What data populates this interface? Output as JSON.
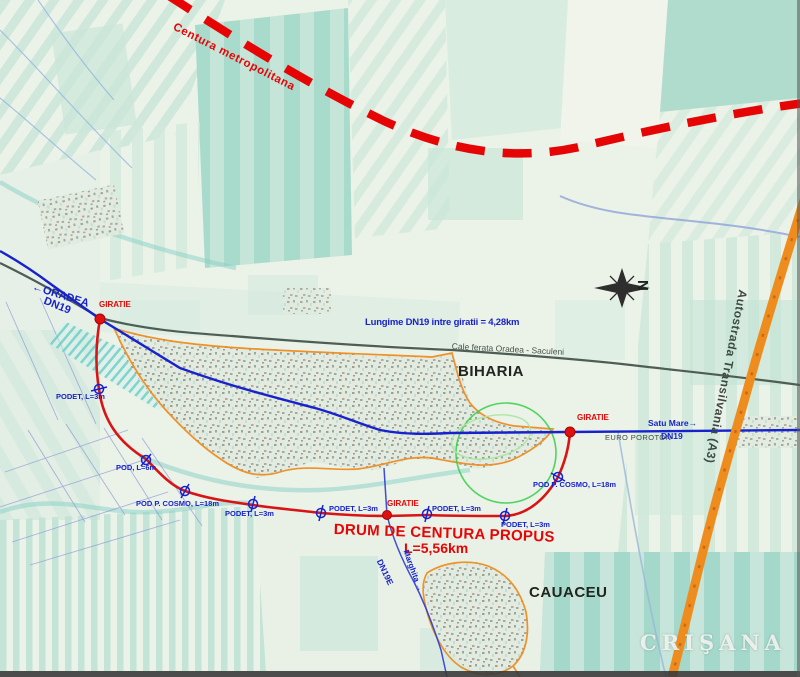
{
  "map": {
    "region_labels": {
      "biharia": "BIHARIA",
      "cauaceu": "CAUACEU"
    },
    "roads": {
      "centura_metropolitana": "Centura metropolitana",
      "dn19_left": "DN19",
      "dn19_right": "DN19",
      "dn19e": "DN19E",
      "autostrada_a3": "Autostrada Transilvania (A3)",
      "cale_ferata": "Cale ferata Oradea - Saculeni",
      "drum_title": "DRUM DE CENTURA PROPUS",
      "drum_length": "L=5,56km",
      "lungime_note": "Lungime DN19 intre giratii = 4,28km"
    },
    "destinations": {
      "oradea": "ORADEA",
      "satu_mare": "Satu Mare",
      "marghita": "Marghita"
    },
    "junctions": {
      "giratie_left": "GIRATIE",
      "giratie_mid": "GIRATIE",
      "giratie_right": "GIRATIE"
    },
    "structures": {
      "podet_3m": "PODET, L=3m",
      "pod_6m": "POD, L=6m",
      "pod_cosmo": "POD P. COSMO, L=18m"
    },
    "poi": {
      "euro_poroton": "EURO POROTON"
    },
    "compass_n": "N",
    "watermark": "CRIŞANA",
    "icons": {
      "arrow_left": "←",
      "arrow_right": "→"
    },
    "colors": {
      "proposed_route_red": "#d81414",
      "ring_dashed_red": "#e60505",
      "dn19_blue": "#1722cc",
      "a3_orange": "#ef8c1e",
      "boundary_orange": "#ef8c1e",
      "study_circle_green": "#35cf49",
      "railway_gray": "#4e5e55"
    }
  }
}
